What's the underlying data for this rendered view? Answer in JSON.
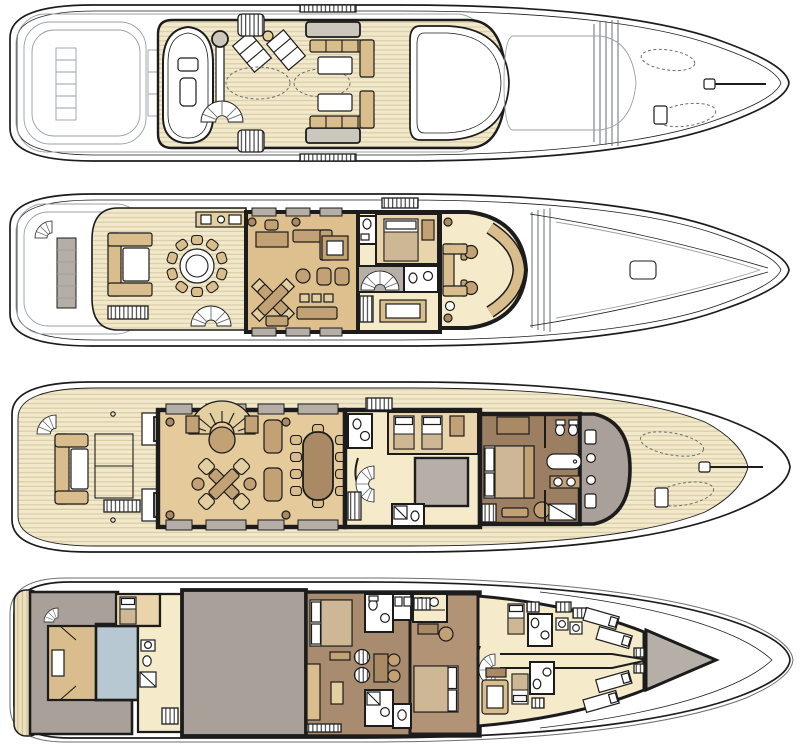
{
  "figure": {
    "type": "yacht-deck-plans",
    "view": "top-down",
    "orientation": "bow-right",
    "deck_count": 4,
    "decks": [
      {
        "id": "sun-deck",
        "order": 1,
        "zones": [
          "aft-ghost-outlines",
          "tender-boat",
          "davit-crane",
          "sun-loungers",
          "spa-pool-outline",
          "fan-stairs",
          "vent-hatches",
          "sun-pads",
          "lounge-sofas",
          "cocktail-tables",
          "radar-arch",
          "mast",
          "foredeck-ghost-gear",
          "bow"
        ]
      },
      {
        "id": "bridge-deck",
        "order": 2,
        "zones": [
          "aft-fan-stairs",
          "window-ghost",
          "alfresco-round-dining-10-seats",
          "buffet-sideboard",
          "lounge-sofa",
          "side-stairs",
          "spiral-stairs",
          "sky-lounge",
          "writing-desk",
          "game-table",
          "sofas",
          "day-head",
          "captain-cabin",
          "stair-lobby",
          "bathroom",
          "wheelhouse",
          "helm-seats",
          "mast",
          "foredeck"
        ]
      },
      {
        "id": "main-deck",
        "order": 3,
        "zones": [
          "aft-fan-stairs",
          "aft-deck-sofa",
          "cocktail-table",
          "settees",
          "curved-staircase",
          "main-salon",
          "card-table",
          "formal-dining-10-seats",
          "lobby",
          "day-head",
          "twin-guest-cabin",
          "pantry",
          "spiral-stairs",
          "owner-stateroom",
          "owner-bed",
          "owner-bathroom",
          "bathtub",
          "dressing-apse",
          "teak-foredeck",
          "tender-outlines",
          "anchor-windlass",
          "bow"
        ]
      },
      {
        "id": "lower-deck",
        "order": 4,
        "zones": [
          "swim-platform",
          "beach-club-garage",
          "tender-bay",
          "store-room",
          "crew-cabin-aft",
          "corridor-bathroom",
          "engine-room",
          "guest-stateroom-aft",
          "guest-bathrooms",
          "dressing-lobby",
          "guest-stateroom-forward",
          "crew-mess",
          "crew-spiral-stairs",
          "crew-cabins",
          "laundry-lockers",
          "bow-crew-bunks",
          "forepeak",
          "bow"
        ]
      }
    ]
  },
  "palette": {
    "paper": "#ffffff",
    "ink": "#1c1c1c",
    "ghost": "#9aa0a5",
    "ghost_dark": "#6a6f72",
    "teak_base": "#f2e8ca",
    "teak_stripe": "#d9cda8",
    "platform_base": "#ece0bd",
    "platform_stripe": "#cfc3a0",
    "window_gray": "#b5aea6",
    "sunpad": "#cbc7bd",
    "furn_light": "#e3cf9f",
    "furn_tan": "#d9bd8c",
    "furn_mid": "#c2a175",
    "furn_brown": "#a98a64",
    "floor_sky": "#ddc08e",
    "floor_salon": "#e5ca9b",
    "floor_cabin": "#ead4ab",
    "floor_cream": "#f5eac9",
    "floor_brown": "#a98b6f",
    "floor_brown_mid": "#b29376",
    "floor_brown_dark": "#9c7f63",
    "gray_room": "#a8a099",
    "gray_block": "#b6afa7",
    "blue_gray": "#b7c8d2",
    "blanket": "#cdb794",
    "white": "#ffffff"
  }
}
